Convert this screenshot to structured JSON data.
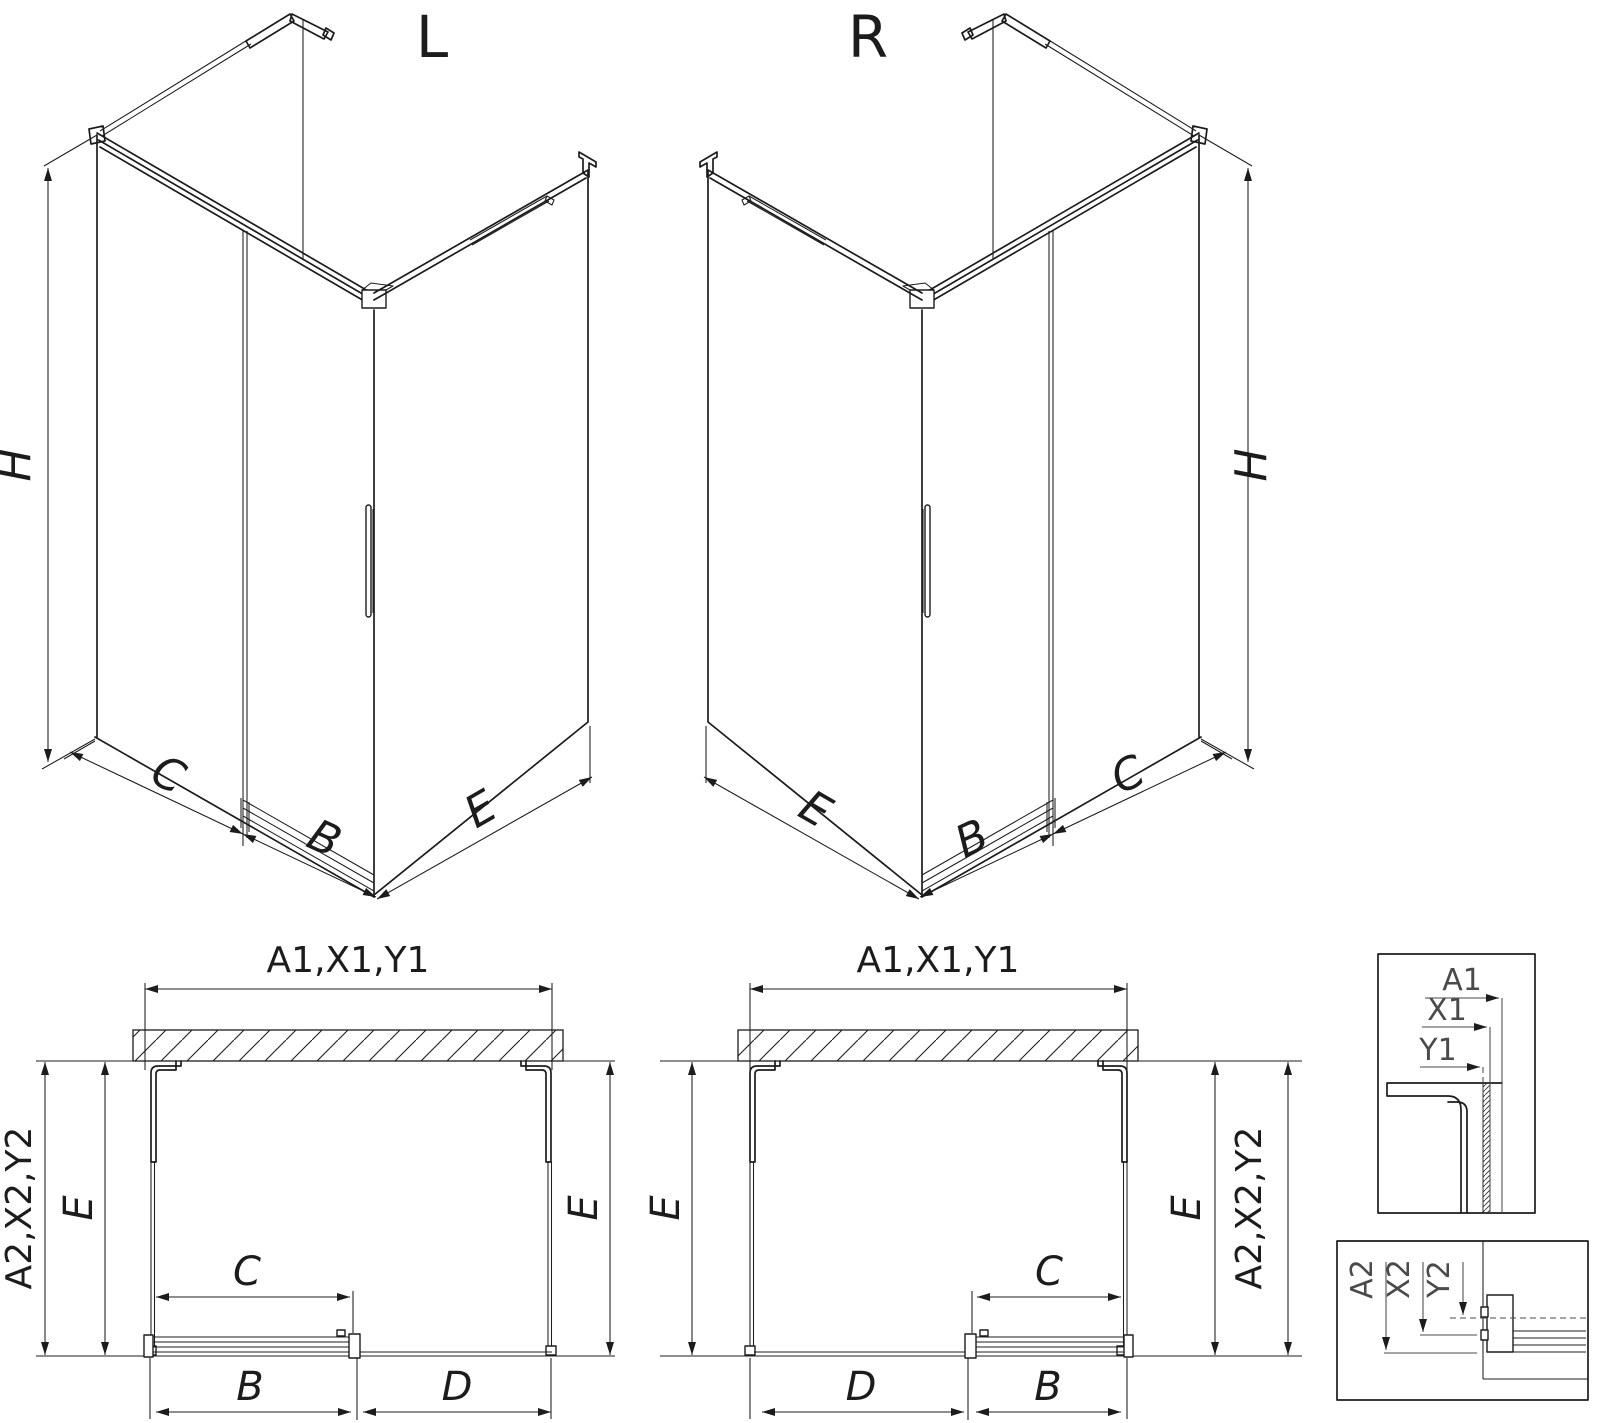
{
  "page": {
    "background": "#ffffff",
    "line_color": "#1c1c1c",
    "detail_label_color": "#4a4a4a"
  },
  "iso_left": {
    "title": "L",
    "dim_height": "H",
    "dim_fixed": "C",
    "dim_door": "B",
    "dim_side": "E"
  },
  "iso_right": {
    "title": "R",
    "dim_height": "H",
    "dim_fixed": "C",
    "dim_door": "B",
    "dim_side": "E"
  },
  "plan_left": {
    "dim_width": "A1,X1,Y1",
    "dim_depth": "A2,X2,Y2",
    "dim_e_left": "E",
    "dim_e_right": "E",
    "dim_c": "C",
    "dim_b": "B",
    "dim_d": "D"
  },
  "plan_right": {
    "dim_width": "A1,X1,Y1",
    "dim_depth": "A2,X2,Y2",
    "dim_e_left": "E",
    "dim_e_right": "E",
    "dim_c": "C",
    "dim_b": "B",
    "dim_d": "D"
  },
  "detail_top": {
    "dim_a": "A1",
    "dim_x": "X1",
    "dim_y": "Y1"
  },
  "detail_bottom": {
    "dim_a": "A2",
    "dim_x": "X2",
    "dim_y": "Y2"
  }
}
